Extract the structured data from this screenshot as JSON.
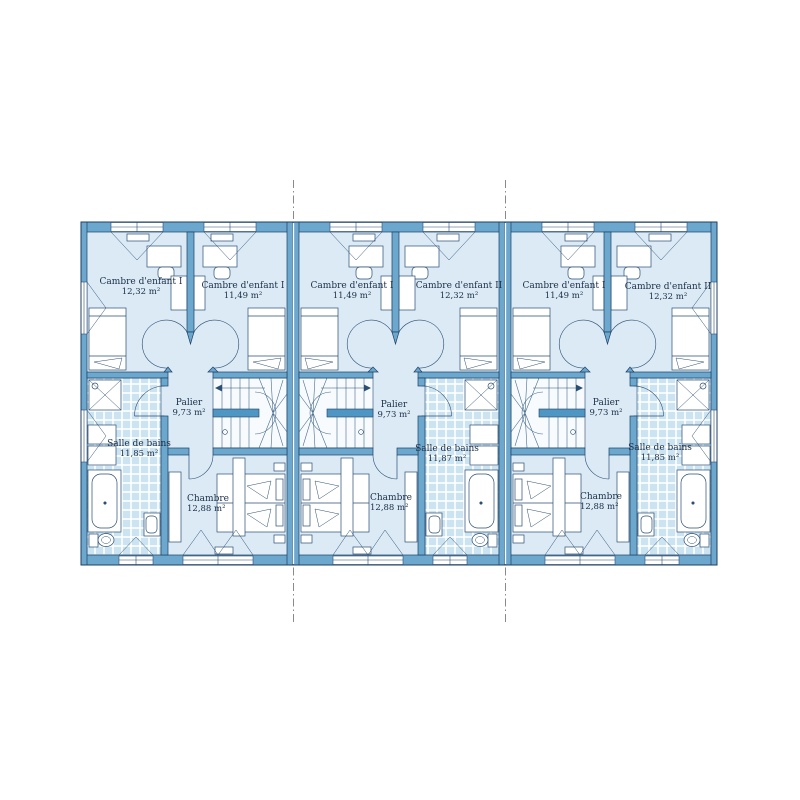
{
  "plan": {
    "colors": {
      "wall": "#6CA8CE",
      "outline": "#1F3F63",
      "floor": "#DBEAF5",
      "tile": "#CCE3F1",
      "stair_bar": "#4E96C3",
      "boundary_dash": "#8a8a8a"
    },
    "units": [
      {
        "label": "unit-1",
        "rooms": {
          "child_left": {
            "name": "Cambre d'enfant I",
            "area": "12,32 m²"
          },
          "child_right": {
            "name": "Cambre d'enfant I",
            "area": "11,49 m²"
          },
          "landing": {
            "name": "Palier",
            "area": "9,73 m²"
          },
          "bathroom": {
            "name": "Salle de bains",
            "area": "11,85 m²"
          },
          "bedroom": {
            "name": "Chambre",
            "area": "12,88 m²"
          }
        }
      },
      {
        "label": "unit-2",
        "rooms": {
          "child_left": {
            "name": "Cambre d'enfant I",
            "area": "11,49 m²"
          },
          "child_right": {
            "name": "Cambre d'enfant II",
            "area": "12,32 m²"
          },
          "landing": {
            "name": "Palier",
            "area": "9,73 m²"
          },
          "bathroom": {
            "name": "Salle de bains",
            "area": "11,87 m²"
          },
          "bedroom": {
            "name": "Chambre",
            "area": "12,88 m²"
          }
        }
      },
      {
        "label": "unit-3",
        "rooms": {
          "child_left": {
            "name": "Cambre d'enfant I",
            "area": "11,49 m²"
          },
          "child_right": {
            "name": "Cambre d'enfant II",
            "area": "12,32 m²"
          },
          "landing": {
            "name": "Palier",
            "area": "9,73 m²"
          },
          "bathroom": {
            "name": "Salle de bains",
            "area": "11,85 m²"
          },
          "bedroom": {
            "name": "Chambre",
            "area": "12,88 m²"
          }
        }
      }
    ]
  }
}
